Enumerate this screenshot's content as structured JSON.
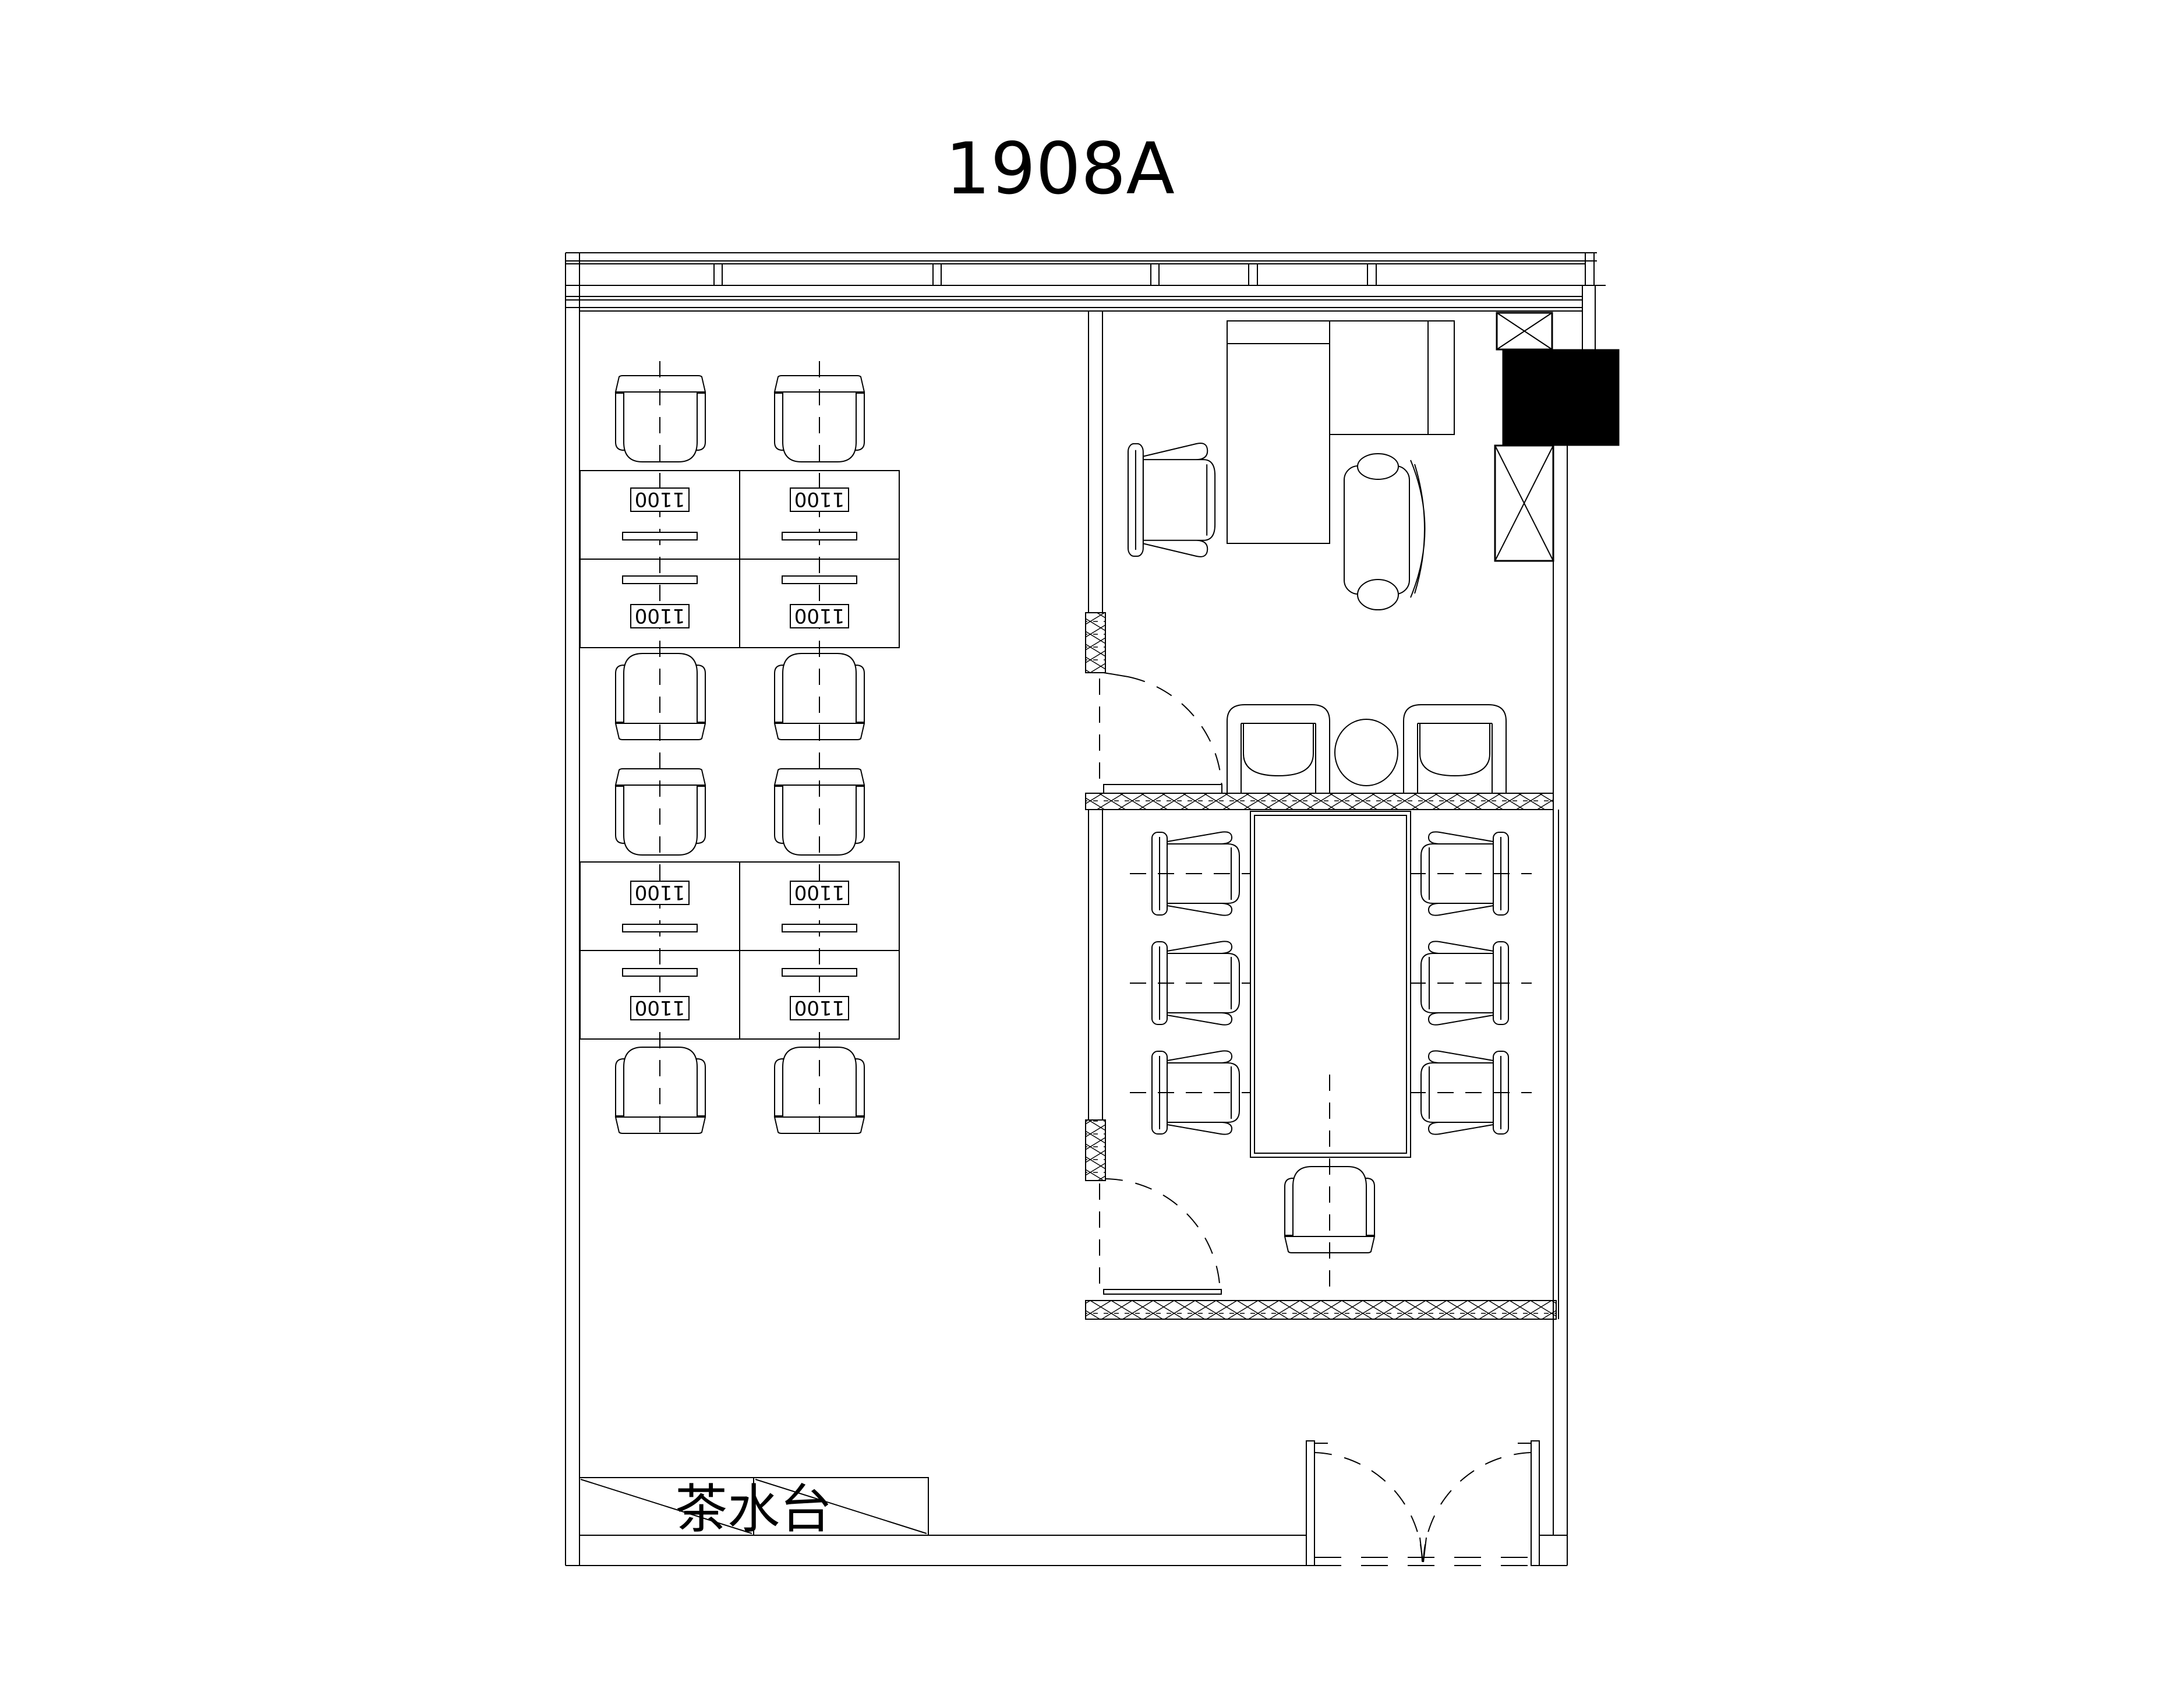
{
  "title": "1908A",
  "colors": {
    "line": "#000000",
    "background": "#ffffff",
    "filled_block": "#000000"
  },
  "open_office": {
    "desk_label": "1100",
    "desk_count": 8,
    "chair_count": 8,
    "banks": 2,
    "columns": 2
  },
  "executive_office": {
    "desk_type": "L-shaped return desk",
    "chair_count": 2
  },
  "lounge": {
    "armchair_count": 2,
    "oval_table_count": 1
  },
  "meeting_room": {
    "table": "conference table",
    "chair_count": 7
  },
  "tea_station": {
    "label": "茶水台"
  },
  "entrance": {
    "door_type": "double swing door"
  }
}
